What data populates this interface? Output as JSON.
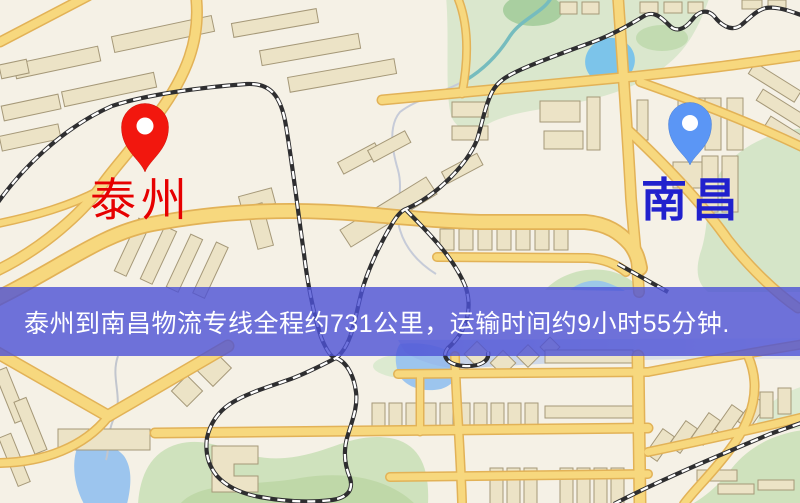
{
  "banner": {
    "text": "泰州到南昌物流专线全程约731公里，运输时间约9小时55分钟.",
    "background": "rgba(76,81,214,0.8)",
    "text_color": "#ffffff"
  },
  "markers": {
    "origin": {
      "label": "泰州",
      "label_color": "#e60000",
      "pin_color": "#f2170e",
      "pin_edge": "#c91208"
    },
    "destination": {
      "label": "南昌",
      "label_color": "#2121cd",
      "pin_color": "#5b96f5",
      "pin_edge": "#4a7fd4"
    }
  },
  "map_colors": {
    "background": "#f5f1e6",
    "road_fill": "#f7d87e",
    "road_casing": "#e2b257",
    "park": "#d5e5c8",
    "water": "#9cc5ee",
    "railway": "#2e2e30",
    "building": "#ece3c6"
  }
}
